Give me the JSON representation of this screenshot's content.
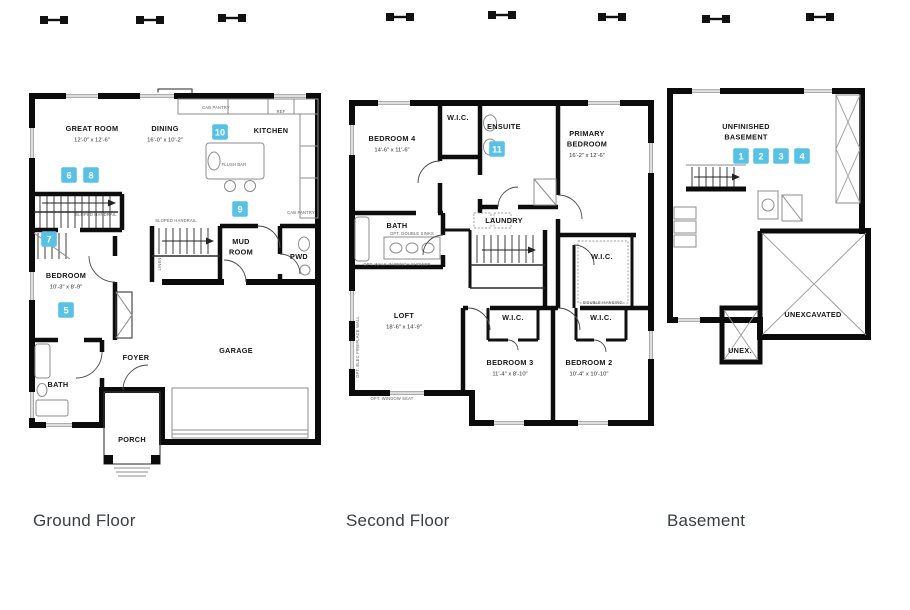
{
  "marker_style": {
    "color": "#58c2e6",
    "text_color": "#ffffff"
  },
  "floors": [
    {
      "id": "ground",
      "caption": "Ground Floor",
      "rooms": [
        {
          "name": "GREAT ROOM",
          "dims": "12'-0\" x 12'-6\"",
          "x": 64,
          "y": 45
        },
        {
          "name": "DINING",
          "dims": "16'-0\" x 10'-2\"",
          "x": 137,
          "y": 45
        },
        {
          "name": "KITCHEN",
          "x": 243,
          "y": 47
        },
        {
          "name": "MUD",
          "name2": "ROOM",
          "x": 213,
          "y": 158
        },
        {
          "name": "PWD",
          "x": 271,
          "y": 173
        },
        {
          "name": "BEDROOM",
          "dims": "10'-3\" x 8'-9\"",
          "x": 38,
          "y": 192
        },
        {
          "name": "BATH",
          "x": 30,
          "y": 301
        },
        {
          "name": "FOYER",
          "x": 108,
          "y": 274
        },
        {
          "name": "GARAGE",
          "x": 208,
          "y": 267
        },
        {
          "name": "PORCH",
          "x": 104,
          "y": 356
        }
      ],
      "annotations": [
        {
          "text": "CAB PANTRY",
          "x": 188,
          "y": 23
        },
        {
          "text": "REF",
          "x": 253,
          "y": 27
        },
        {
          "text": "FLUSH BAR",
          "x": 206,
          "y": 80
        },
        {
          "text": "CAB PANTRY",
          "x": 273,
          "y": 128
        },
        {
          "text": "SLOPED HANDRAIL",
          "x": 68,
          "y": 130
        },
        {
          "text": "SLOPED HANDRAIL",
          "x": 148,
          "y": 136
        },
        {
          "text": "LINEN",
          "x": 133,
          "y": 178,
          "rotate": -90
        }
      ],
      "markers": [
        {
          "n": "5",
          "x": 38,
          "y": 224
        },
        {
          "n": "6",
          "x": 41,
          "y": 89
        },
        {
          "n": "7",
          "x": 21,
          "y": 153
        },
        {
          "n": "8",
          "x": 63,
          "y": 89
        },
        {
          "n": "9",
          "x": 212,
          "y": 123
        },
        {
          "n": "10",
          "x": 192,
          "y": 46
        }
      ]
    },
    {
      "id": "second",
      "caption": "Second Floor",
      "rooms": [
        {
          "name": "BEDROOM 4",
          "dims": "14'-6\" x 11'-6\"",
          "x": 44,
          "y": 46
        },
        {
          "name": "W.I.C.",
          "x": 110,
          "y": 25
        },
        {
          "name": "ENSUITE",
          "x": 156,
          "y": 34
        },
        {
          "name": "PRIMARY",
          "name2": "BEDROOM",
          "dims": "16'-2\" x 12'-6\"",
          "x": 239,
          "y": 41
        },
        {
          "name": "BATH",
          "x": 49,
          "y": 133
        },
        {
          "name": "LAUNDRY",
          "x": 156,
          "y": 128
        },
        {
          "name": "W.I.C.",
          "x": 254,
          "y": 164
        },
        {
          "name": "LOFT",
          "dims": "18'-6\" x 14'-9\"",
          "x": 56,
          "y": 223
        },
        {
          "name": "W.I.C.",
          "x": 165,
          "y": 225
        },
        {
          "name": "W.I.C.",
          "x": 253,
          "y": 225
        },
        {
          "name": "BEDROOM 3",
          "dims": "11'-4\" x 8'-10\"",
          "x": 162,
          "y": 270
        },
        {
          "name": "BEDROOM 2",
          "dims": "10'-4\" x 10'-10\"",
          "x": 241,
          "y": 270
        }
      ],
      "annotations": [
        {
          "text": "OPT. DOUBLE SINKS",
          "x": 64,
          "y": 140
        },
        {
          "text": "OPT. WALK-IN BENCH SHOWER",
          "x": 49,
          "y": 171
        },
        {
          "text": "DOUBLE HANGING",
          "x": 255,
          "y": 209
        },
        {
          "text": "OPT. ELEC FIREPLACE WALL",
          "x": 11,
          "y": 252,
          "rotate": -90
        },
        {
          "text": "OPT. WINDOW SEAT",
          "x": 44,
          "y": 305
        }
      ],
      "markers": [
        {
          "n": "11",
          "x": 149,
          "y": 54
        }
      ]
    },
    {
      "id": "basement",
      "caption": "Basement",
      "rooms": [
        {
          "name": "UNFINISHED",
          "name2": "BASEMENT",
          "x": 80,
          "y": 46
        },
        {
          "name": "UNEXCAVATED",
          "x": 147,
          "y": 234
        },
        {
          "name": "UNEX.",
          "x": 74,
          "y": 270
        }
      ],
      "annotations": [],
      "markers": [
        {
          "n": "1",
          "x": 75,
          "y": 73
        },
        {
          "n": "2",
          "x": 95,
          "y": 73
        },
        {
          "n": "3",
          "x": 115,
          "y": 73
        },
        {
          "n": "4",
          "x": 136,
          "y": 73
        }
      ]
    }
  ],
  "decorations": {
    "above_marks": [
      {
        "x": 40,
        "y": 16
      },
      {
        "x": 136,
        "y": 16
      },
      {
        "x": 218,
        "y": 14
      },
      {
        "x": 386,
        "y": 13
      },
      {
        "x": 488,
        "y": 11
      },
      {
        "x": 598,
        "y": 13
      },
      {
        "x": 702,
        "y": 15
      },
      {
        "x": 806,
        "y": 13
      }
    ]
  }
}
